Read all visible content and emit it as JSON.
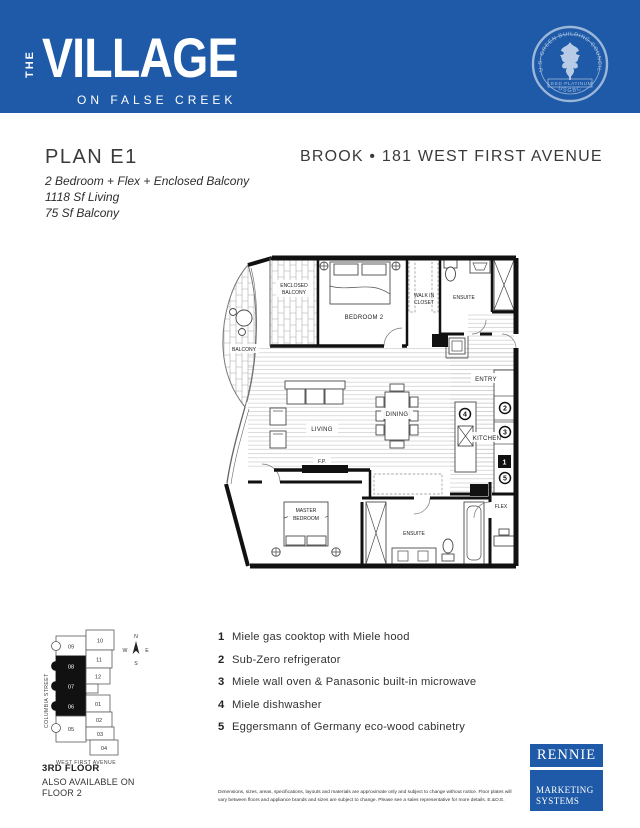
{
  "header": {
    "banner_color": "#1e5aa8",
    "brand": {
      "the": "THE",
      "name": "VILLAGE",
      "tagline": "ON FALSE CREEK"
    },
    "seal": {
      "arc_text": "U.S. GREEN BUILDING COUNCIL",
      "ribbon_text": "LEED PLATINUM",
      "bottom_text": "USGBC"
    }
  },
  "plan_info": {
    "plan_name": "PLAN E1",
    "features": [
      "2 Bedroom + Flex + Enclosed Balcony",
      "1118 Sf Living",
      "75 Sf Balcony"
    ],
    "building_title": "BROOK • 181 WEST FIRST AVENUE"
  },
  "floorplan": {
    "labels": {
      "enclosed_balcony_line1": "ENCLOSED",
      "enclosed_balcony_line2": "BALCONY",
      "balcony": "BALCONY",
      "bedroom2": "BEDROOM 2",
      "walkin_line1": "WALK IN",
      "walkin_line2": "CLOSET",
      "ensuite_top": "ENSUITE",
      "entry": "ENTRY",
      "living": "LIVING",
      "dining": "DINING",
      "kitchen": "KITCHEN",
      "fireplace": "F.P.",
      "master_line1": "MASTER",
      "master_line2": "BEDROOM",
      "ensuite_bottom": "ENSUITE",
      "flex": "FLEX"
    },
    "markers": {
      "m1": "1",
      "m2": "2",
      "m3": "3",
      "m4": "4",
      "m5": "5"
    }
  },
  "legend": {
    "items": [
      {
        "num": "1",
        "text": "Miele gas cooktop with Miele hood"
      },
      {
        "num": "2",
        "text": "Sub-Zero refrigerator"
      },
      {
        "num": "3",
        "text": "Miele wall oven & Panasonic built-in microwave"
      },
      {
        "num": "4",
        "text": "Miele dishwasher"
      },
      {
        "num": "5",
        "text": "Eggersmann of Germany eco-wood cabinetry"
      }
    ]
  },
  "keyplan": {
    "street_left": "COLUMBIA STREET",
    "street_bottom": "WEST FIRST AVENUE",
    "compass": {
      "n": "N",
      "w": "W",
      "e": "E",
      "s": "S"
    },
    "units_left": [
      {
        "id": "09",
        "highlight": false
      },
      {
        "id": "08",
        "highlight": true
      },
      {
        "id": "07",
        "highlight": true
      },
      {
        "id": "06",
        "highlight": true
      },
      {
        "id": "05",
        "highlight": false
      }
    ],
    "units_right": [
      {
        "id": "10"
      },
      {
        "id": "11"
      },
      {
        "id": "12"
      },
      {
        "id": "01"
      },
      {
        "id": "02"
      },
      {
        "id": "03"
      },
      {
        "id": "04"
      }
    ],
    "floor_label": "3RD FLOOR",
    "availability_line1": "ALSO AVAILABLE ON",
    "availability_line2": "FLOOR 2"
  },
  "footer": {
    "disclaimer_line1": "Dimensions, sizes, areas, specifications, layouts and materials are approximate only and subject to change without notice. Floor plates will",
    "disclaimer_line2": "vary between floors and appliance brands and sizes are subject to change. Please see a sales representative for more details. E.&O.E.",
    "rennie": {
      "name": "RENNIE",
      "line1": "MARKETING",
      "line2": "SYSTEMS",
      "brand_color": "#1e5aa8"
    }
  }
}
